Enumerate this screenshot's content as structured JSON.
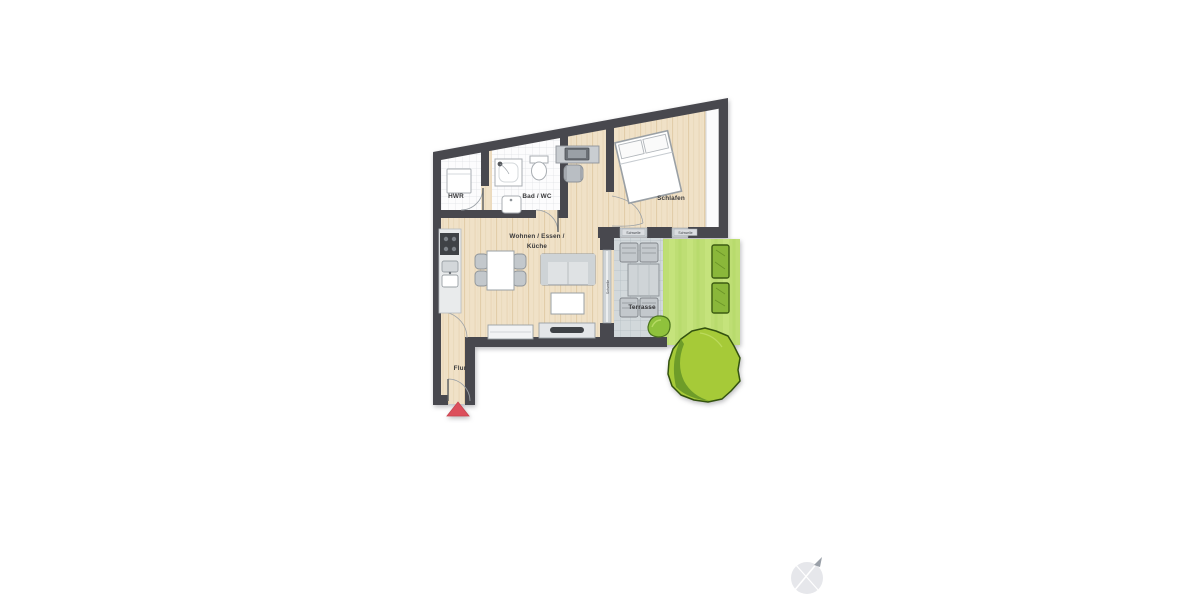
{
  "labels": {
    "hwr": "HWR",
    "bad_wc": "Bad / WC",
    "schlafen": "Schlafen",
    "wohnen_line1": "Wohnen / Essen /",
    "wohnen_line2": "Küche",
    "flur": "Flur",
    "terrasse": "Terrasse",
    "schwelle": "Schwelle"
  },
  "icons": {
    "north_arrow": "compass-north-arrow",
    "entrance_marker": "red-entrance-triangle"
  },
  "colors": {
    "wall": "#48484e",
    "wood1": "#f0e1c7",
    "wood2": "#e2cda9",
    "tile-bg": "#fcfcfd",
    "tile-line": "#dfe2e5",
    "terrace-bg": "#d2d8db",
    "terrace-line": "#b5bec4",
    "lawn": "#bede74",
    "lawn-light": "#c9e683",
    "hedge": "#8ab73a",
    "tree": "#a6ca38",
    "tree-dark": "#6e9c29",
    "green-outline": "#33520f",
    "accent-red": "#dc4f5c",
    "furn-fill": "#dfe2e4",
    "furn-border": "#8e9398",
    "label": "#3a3a3c",
    "compass": "#e2e3e7"
  }
}
